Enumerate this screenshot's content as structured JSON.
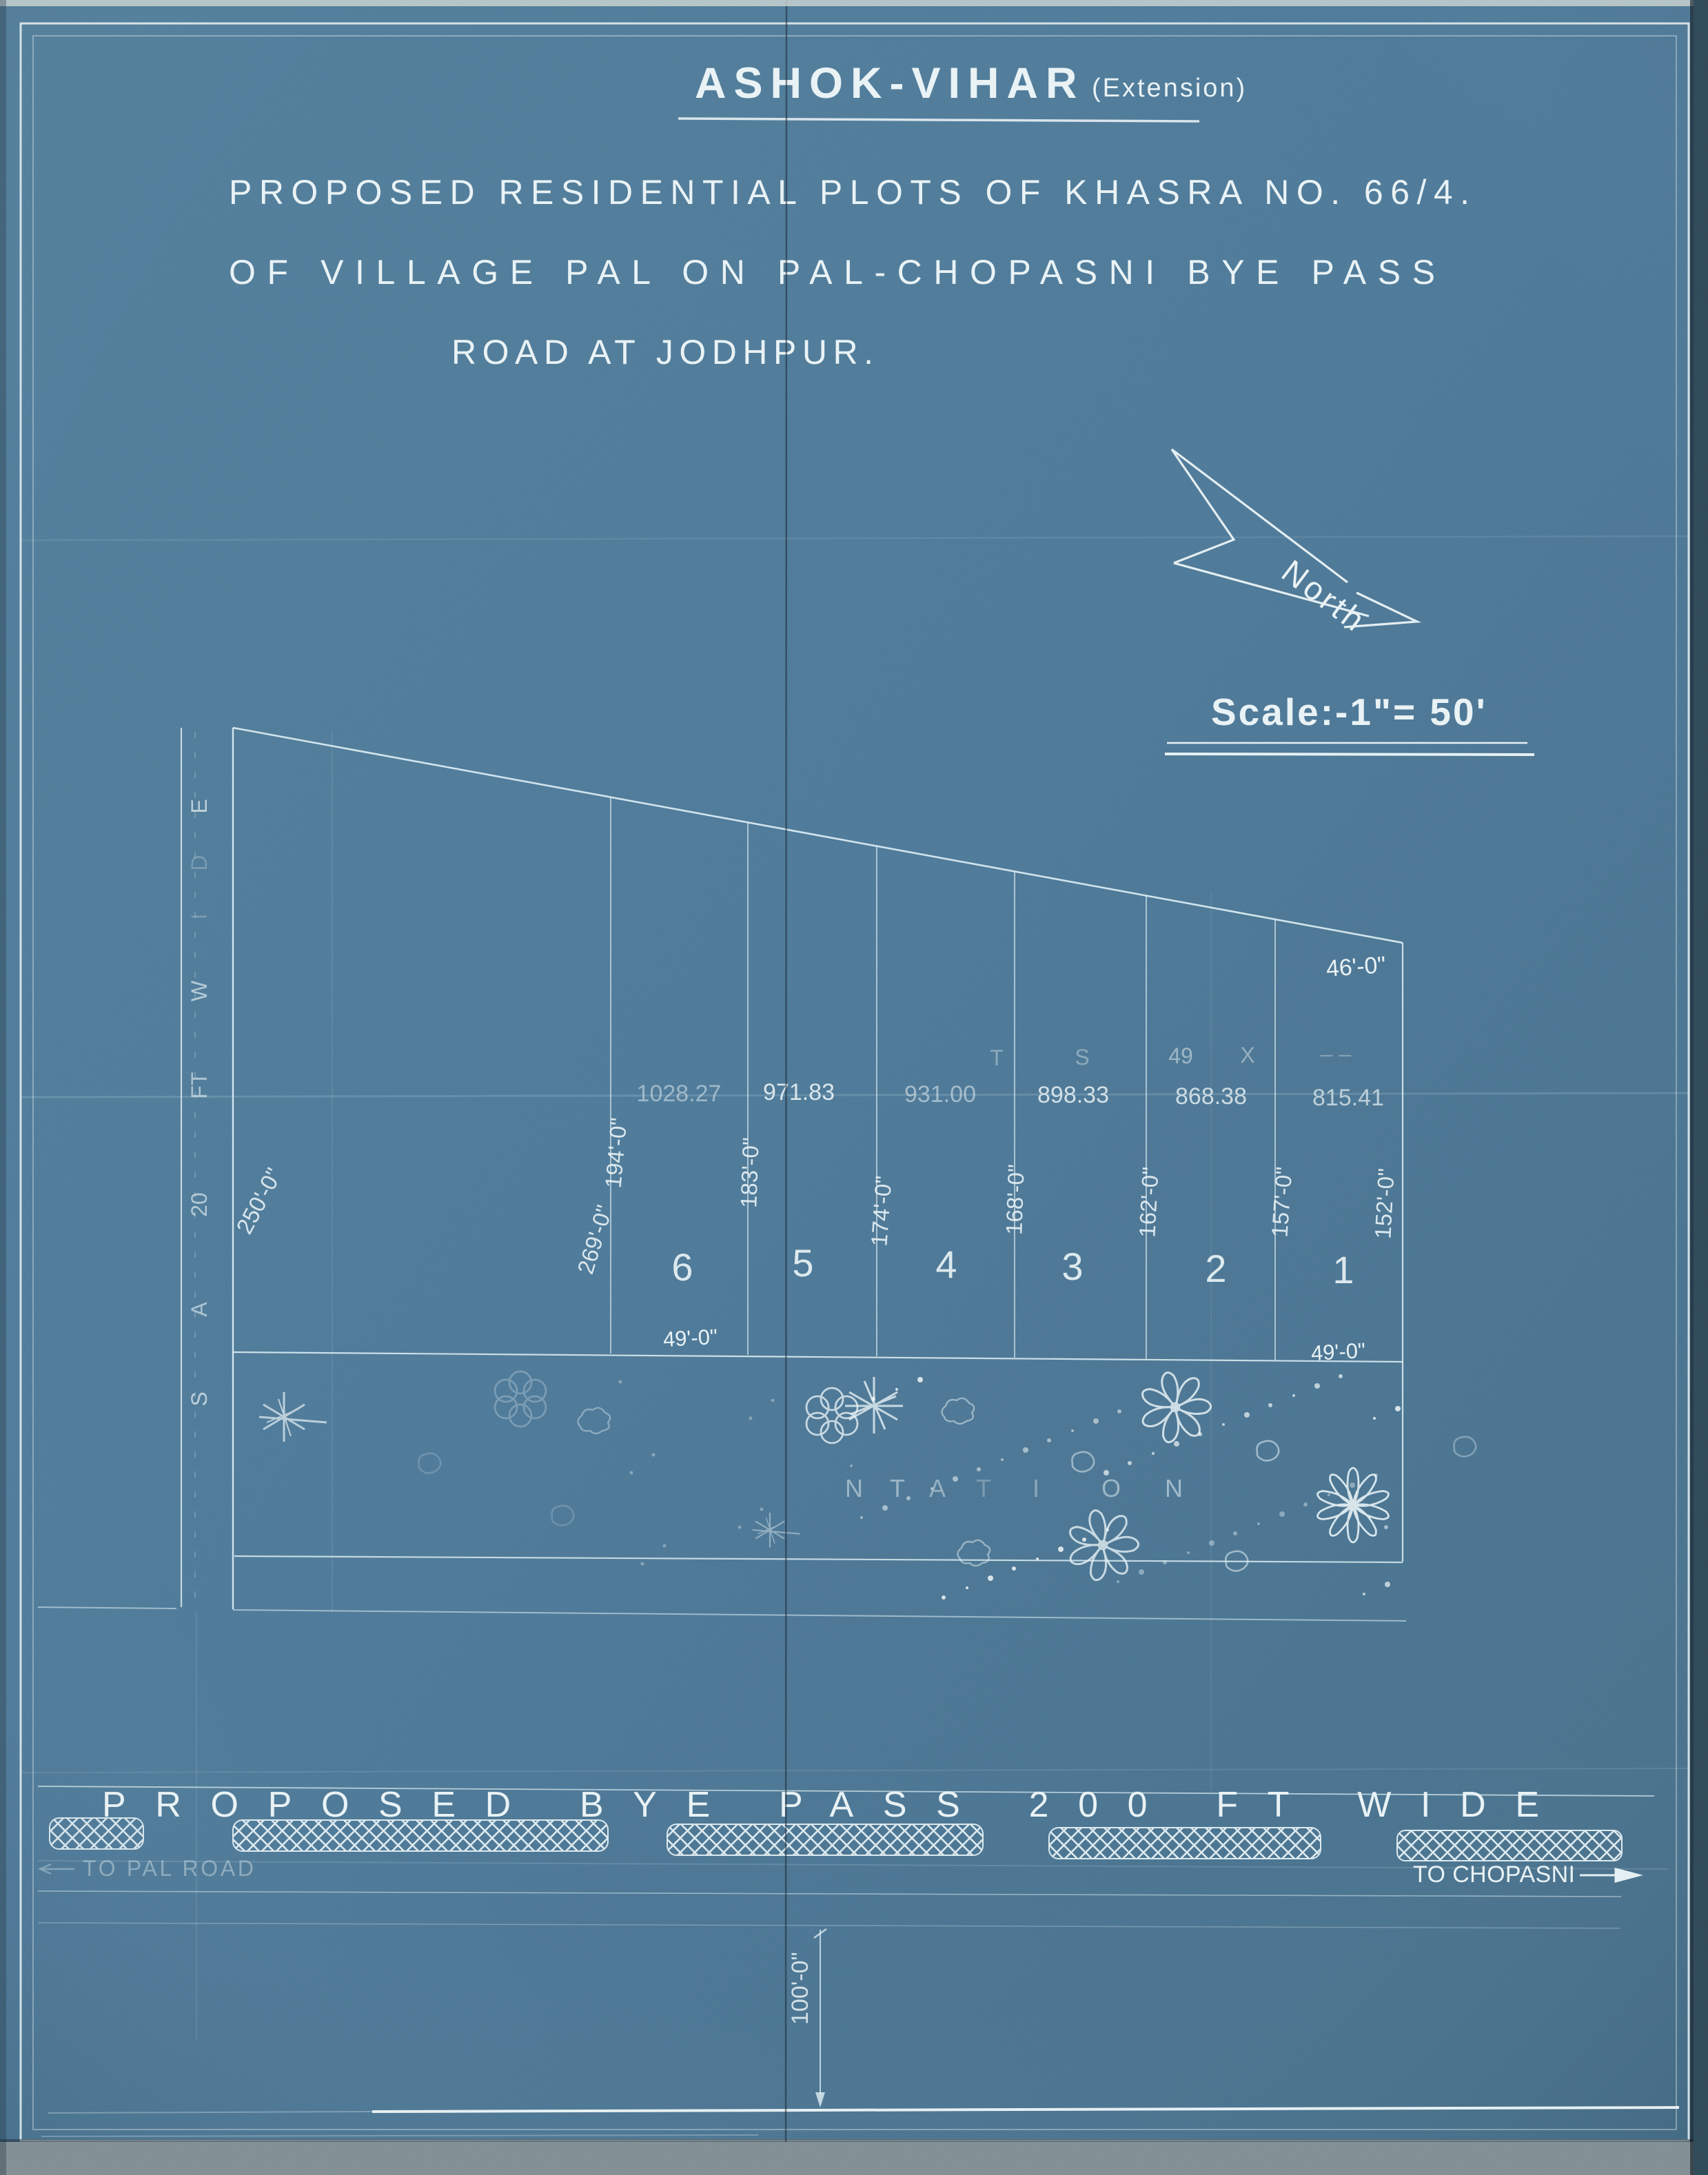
{
  "title": {
    "main": "ASHOK-VIHAR",
    "suffix": "(Extension)"
  },
  "subtitle": {
    "line1": "PROPOSED RESIDENTIAL PLOTS OF KHASRA NO. 66/4.",
    "line2": "OF VILLAGE PAL ON PAL-CHOPASNI BYE PASS",
    "line3": "ROAD AT JODHPUR."
  },
  "compass": {
    "label": "North"
  },
  "scale_note": {
    "label": "Scale:-1\"= 50'"
  },
  "west_road": {
    "letters": [
      "E",
      "D",
      "I",
      "W",
      "FT",
      "20",
      "A",
      "S"
    ]
  },
  "ghost_row": [
    "T",
    "S",
    "49",
    "X",
    "– –"
  ],
  "plots": {
    "numbers": [
      "6",
      "5",
      "4",
      "3",
      "2",
      "1"
    ],
    "areas": [
      "1028.27",
      "971.83",
      "931.00",
      "898.33",
      "868.38",
      "815.41"
    ]
  },
  "side_dims": [
    "250'-0\"",
    "269'-0\"",
    "194'-0\"",
    "183'-0\"",
    "174'-0\"",
    "168'-0\"",
    "162'-0\"",
    "157'-0\"",
    "152'-0\""
  ],
  "dims": {
    "top_right": "46'-0\"",
    "bottom_left": "49'-0\"",
    "bottom_right": "49'-0\"",
    "south_road": "100'-0\""
  },
  "plantation": {
    "letters": [
      "N",
      "T",
      "A",
      "T",
      "I",
      "O",
      "N"
    ]
  },
  "byepass": {
    "label": "PROPOSED BYE PASS 200 FT WIDE",
    "to_pal": "TO PAL ROAD",
    "to_chopasni": "TO CHOPASNI"
  },
  "colors": {
    "paper": "#3c6d8f",
    "ink": "#e8f2f5",
    "ink_dim": "#aacbd8"
  }
}
